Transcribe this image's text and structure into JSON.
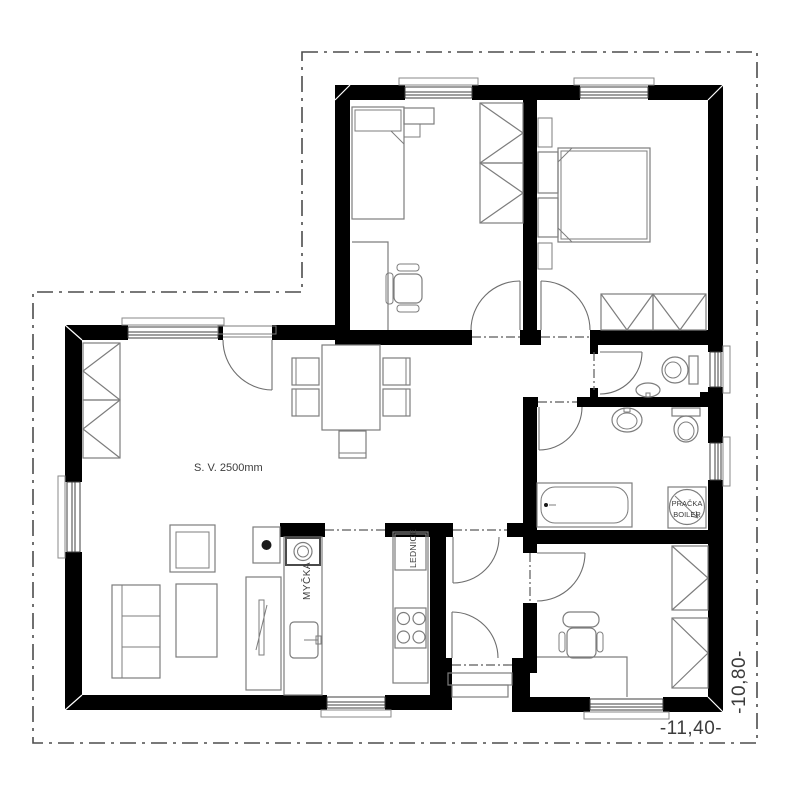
{
  "plan": {
    "type": "house floor plan drawing",
    "labels": {
      "ceiling_height": "S. V. 2500mm",
      "dishwasher": "MYČKA",
      "fridge": "LEDNICE",
      "washer_line1": "PRAČKA",
      "washer_line2": "BOILER"
    },
    "dimensions": {
      "width_total": "-11,40-",
      "depth_total": "-10,80-"
    },
    "icons": {
      "wardrobe": "rectangle with triangle apex toward wall",
      "door": "quarter-circle swing arc",
      "window": "white wall gap with double glazing lines",
      "washer_boiler": "square with circle and diagonal arrow",
      "stove": "four burner circles",
      "property_line": "dash-dot boundary"
    },
    "colors": {
      "wall": "#000000",
      "furniture_stroke": "#7d7d7d",
      "boundary_stroke": "#4d4d4d",
      "text": "#3c3c3c",
      "background": "#ffffff"
    }
  }
}
